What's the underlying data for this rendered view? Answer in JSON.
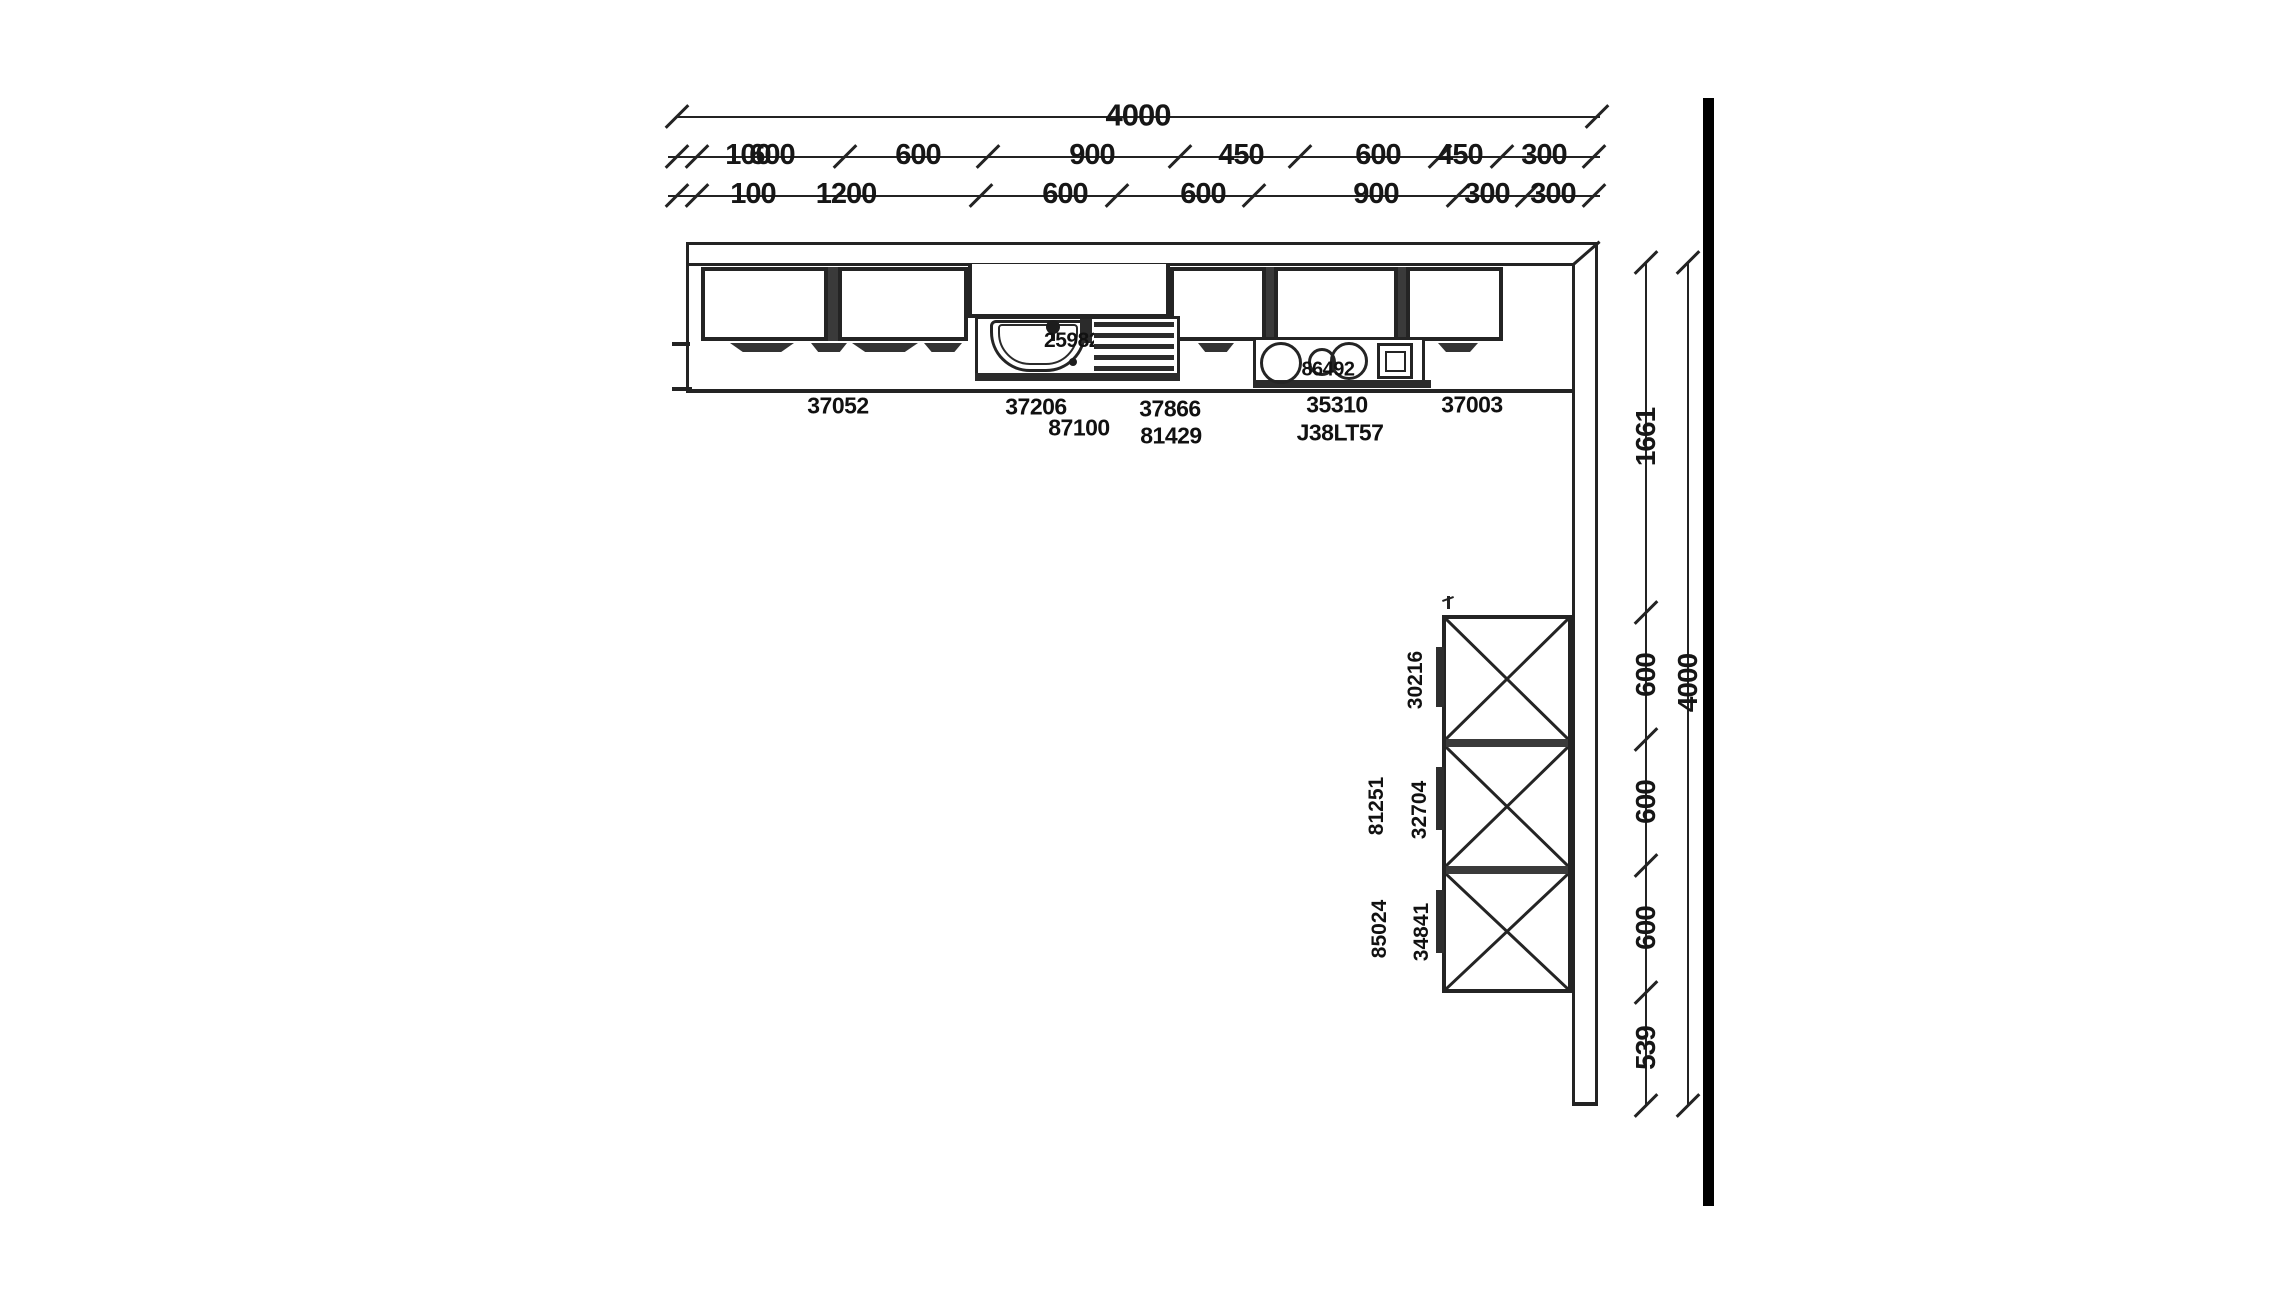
{
  "drawing": {
    "title": "kitchen-layout-plan",
    "wall_note": "right-wall"
  },
  "dims_top": {
    "overall": "4000",
    "row2": [
      "100",
      "600",
      "600",
      "900",
      "450",
      "600",
      "450",
      "300"
    ],
    "row3": [
      "100",
      "1200",
      "600",
      "600",
      "900",
      "300",
      "300"
    ]
  },
  "dims_right": {
    "overall": "4000",
    "segments": [
      "1661",
      "600",
      "600",
      "600",
      "539"
    ]
  },
  "cabinet_labels": {
    "run_row1": [
      "37052",
      "37206",
      "37866",
      "35310",
      "37003"
    ],
    "run_row2": [
      "87100",
      "81429",
      "J38LT57"
    ],
    "sink_code": "25982",
    "cooktop_code": "86492",
    "tall_units": [
      "30216",
      "32704",
      "34841"
    ],
    "tall_units_inner": [
      "81251",
      "85024"
    ]
  },
  "colors": {
    "line": "#232323",
    "wall": "#000000",
    "background": "#ffffff"
  }
}
